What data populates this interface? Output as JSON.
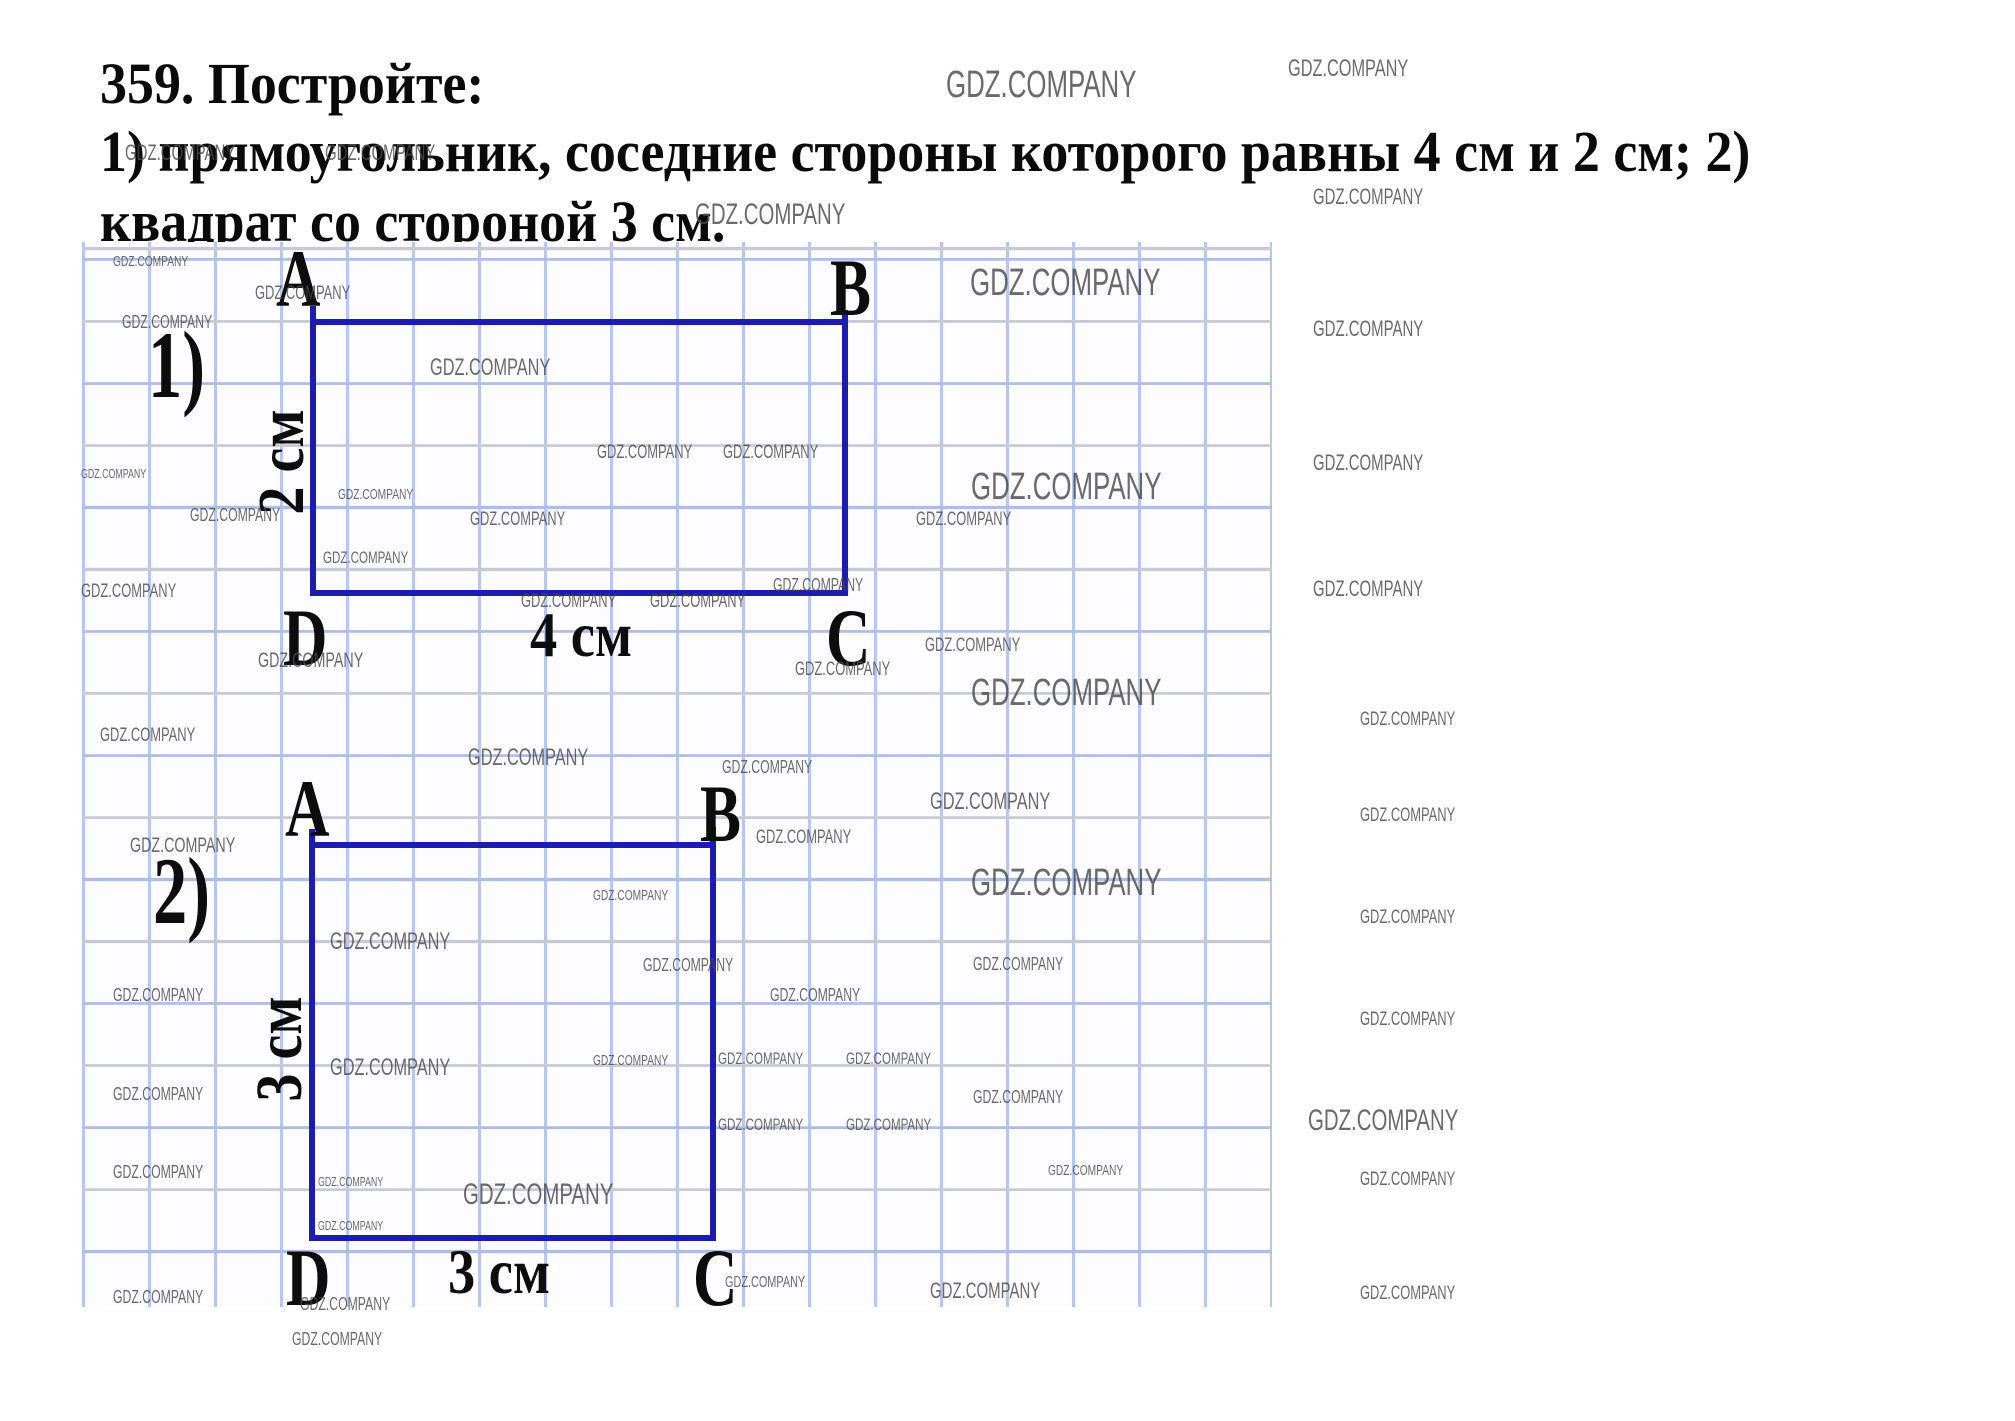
{
  "problem": {
    "line1": "359. Постройте:",
    "line2": "1) прямоугольник, соседние стороны которого равны 4 см и 2 см; 2)",
    "line3": "квадрат со стороной 3 см."
  },
  "fig1": {
    "index": "1)",
    "a": "A",
    "b": "B",
    "c": "C",
    "d": "D",
    "width_label": "4 см",
    "height_label": "2 см"
  },
  "fig2": {
    "index": "2)",
    "a": "A",
    "b": "B",
    "c": "C",
    "d": "D",
    "width_label": "3 см",
    "height_label": "3 см"
  },
  "colors": {
    "shape": "#1c1cb0",
    "grid_vertical": "#b4c8f0",
    "grid_horizontal_blue": "#aebce8",
    "grid_horizontal_gray": "#c9c9d6",
    "text": "#0a0a0a",
    "watermark": "#4a4a4a"
  },
  "watermark_text": "GDZ.COMPANY",
  "watermarks": [
    {
      "x": 946,
      "y": 66,
      "s": 38
    },
    {
      "x": 1288,
      "y": 57,
      "s": 24
    },
    {
      "x": 125,
      "y": 142,
      "s": 22
    },
    {
      "x": 325,
      "y": 142,
      "s": 22
    },
    {
      "x": 695,
      "y": 200,
      "s": 30
    },
    {
      "x": 1313,
      "y": 186,
      "s": 22
    },
    {
      "x": 113,
      "y": 254,
      "s": 15
    },
    {
      "x": 970,
      "y": 264,
      "s": 38
    },
    {
      "x": 255,
      "y": 284,
      "s": 19
    },
    {
      "x": 1313,
      "y": 318,
      "s": 22
    },
    {
      "x": 122,
      "y": 313,
      "s": 18
    },
    {
      "x": 430,
      "y": 356,
      "s": 24
    },
    {
      "x": 597,
      "y": 443,
      "s": 19
    },
    {
      "x": 723,
      "y": 443,
      "s": 19
    },
    {
      "x": 81,
      "y": 467,
      "s": 13
    },
    {
      "x": 190,
      "y": 506,
      "s": 18
    },
    {
      "x": 338,
      "y": 487,
      "s": 15
    },
    {
      "x": 470,
      "y": 510,
      "s": 19
    },
    {
      "x": 323,
      "y": 549,
      "s": 17
    },
    {
      "x": 916,
      "y": 510,
      "s": 19
    },
    {
      "x": 1313,
      "y": 452,
      "s": 22
    },
    {
      "x": 971,
      "y": 468,
      "s": 38
    },
    {
      "x": 773,
      "y": 576,
      "s": 18
    },
    {
      "x": 521,
      "y": 592,
      "s": 19
    },
    {
      "x": 650,
      "y": 592,
      "s": 19
    },
    {
      "x": 81,
      "y": 582,
      "s": 19
    },
    {
      "x": 258,
      "y": 650,
      "s": 21
    },
    {
      "x": 795,
      "y": 660,
      "s": 19
    },
    {
      "x": 925,
      "y": 636,
      "s": 19
    },
    {
      "x": 100,
      "y": 726,
      "s": 19
    },
    {
      "x": 468,
      "y": 746,
      "s": 24
    },
    {
      "x": 722,
      "y": 758,
      "s": 18
    },
    {
      "x": 930,
      "y": 790,
      "s": 24
    },
    {
      "x": 971,
      "y": 674,
      "s": 38
    },
    {
      "x": 1313,
      "y": 578,
      "s": 22
    },
    {
      "x": 130,
      "y": 835,
      "s": 21
    },
    {
      "x": 756,
      "y": 828,
      "s": 19
    },
    {
      "x": 971,
      "y": 864,
      "s": 38
    },
    {
      "x": 593,
      "y": 888,
      "s": 15
    },
    {
      "x": 330,
      "y": 930,
      "s": 24
    },
    {
      "x": 643,
      "y": 956,
      "s": 18
    },
    {
      "x": 113,
      "y": 986,
      "s": 18
    },
    {
      "x": 770,
      "y": 986,
      "s": 18
    },
    {
      "x": 973,
      "y": 955,
      "s": 18
    },
    {
      "x": 330,
      "y": 1056,
      "s": 24
    },
    {
      "x": 593,
      "y": 1053,
      "s": 15
    },
    {
      "x": 718,
      "y": 1050,
      "s": 17
    },
    {
      "x": 846,
      "y": 1050,
      "s": 17
    },
    {
      "x": 113,
      "y": 1085,
      "s": 18
    },
    {
      "x": 973,
      "y": 1088,
      "s": 18
    },
    {
      "x": 1308,
      "y": 1106,
      "s": 30
    },
    {
      "x": 718,
      "y": 1116,
      "s": 17
    },
    {
      "x": 846,
      "y": 1116,
      "s": 17
    },
    {
      "x": 113,
      "y": 1163,
      "s": 18
    },
    {
      "x": 1048,
      "y": 1163,
      "s": 15
    },
    {
      "x": 318,
      "y": 1175,
      "s": 13
    },
    {
      "x": 463,
      "y": 1180,
      "s": 30
    },
    {
      "x": 318,
      "y": 1219,
      "s": 13
    },
    {
      "x": 1360,
      "y": 710,
      "s": 19
    },
    {
      "x": 1360,
      "y": 806,
      "s": 19
    },
    {
      "x": 1360,
      "y": 908,
      "s": 19
    },
    {
      "x": 1360,
      "y": 1010,
      "s": 19
    },
    {
      "x": 1360,
      "y": 1170,
      "s": 19
    },
    {
      "x": 1360,
      "y": 1284,
      "s": 19
    },
    {
      "x": 113,
      "y": 1288,
      "s": 18
    },
    {
      "x": 300,
      "y": 1295,
      "s": 18
    },
    {
      "x": 725,
      "y": 1275,
      "s": 16
    },
    {
      "x": 930,
      "y": 1280,
      "s": 22
    },
    {
      "x": 292,
      "y": 1330,
      "s": 18
    }
  ]
}
